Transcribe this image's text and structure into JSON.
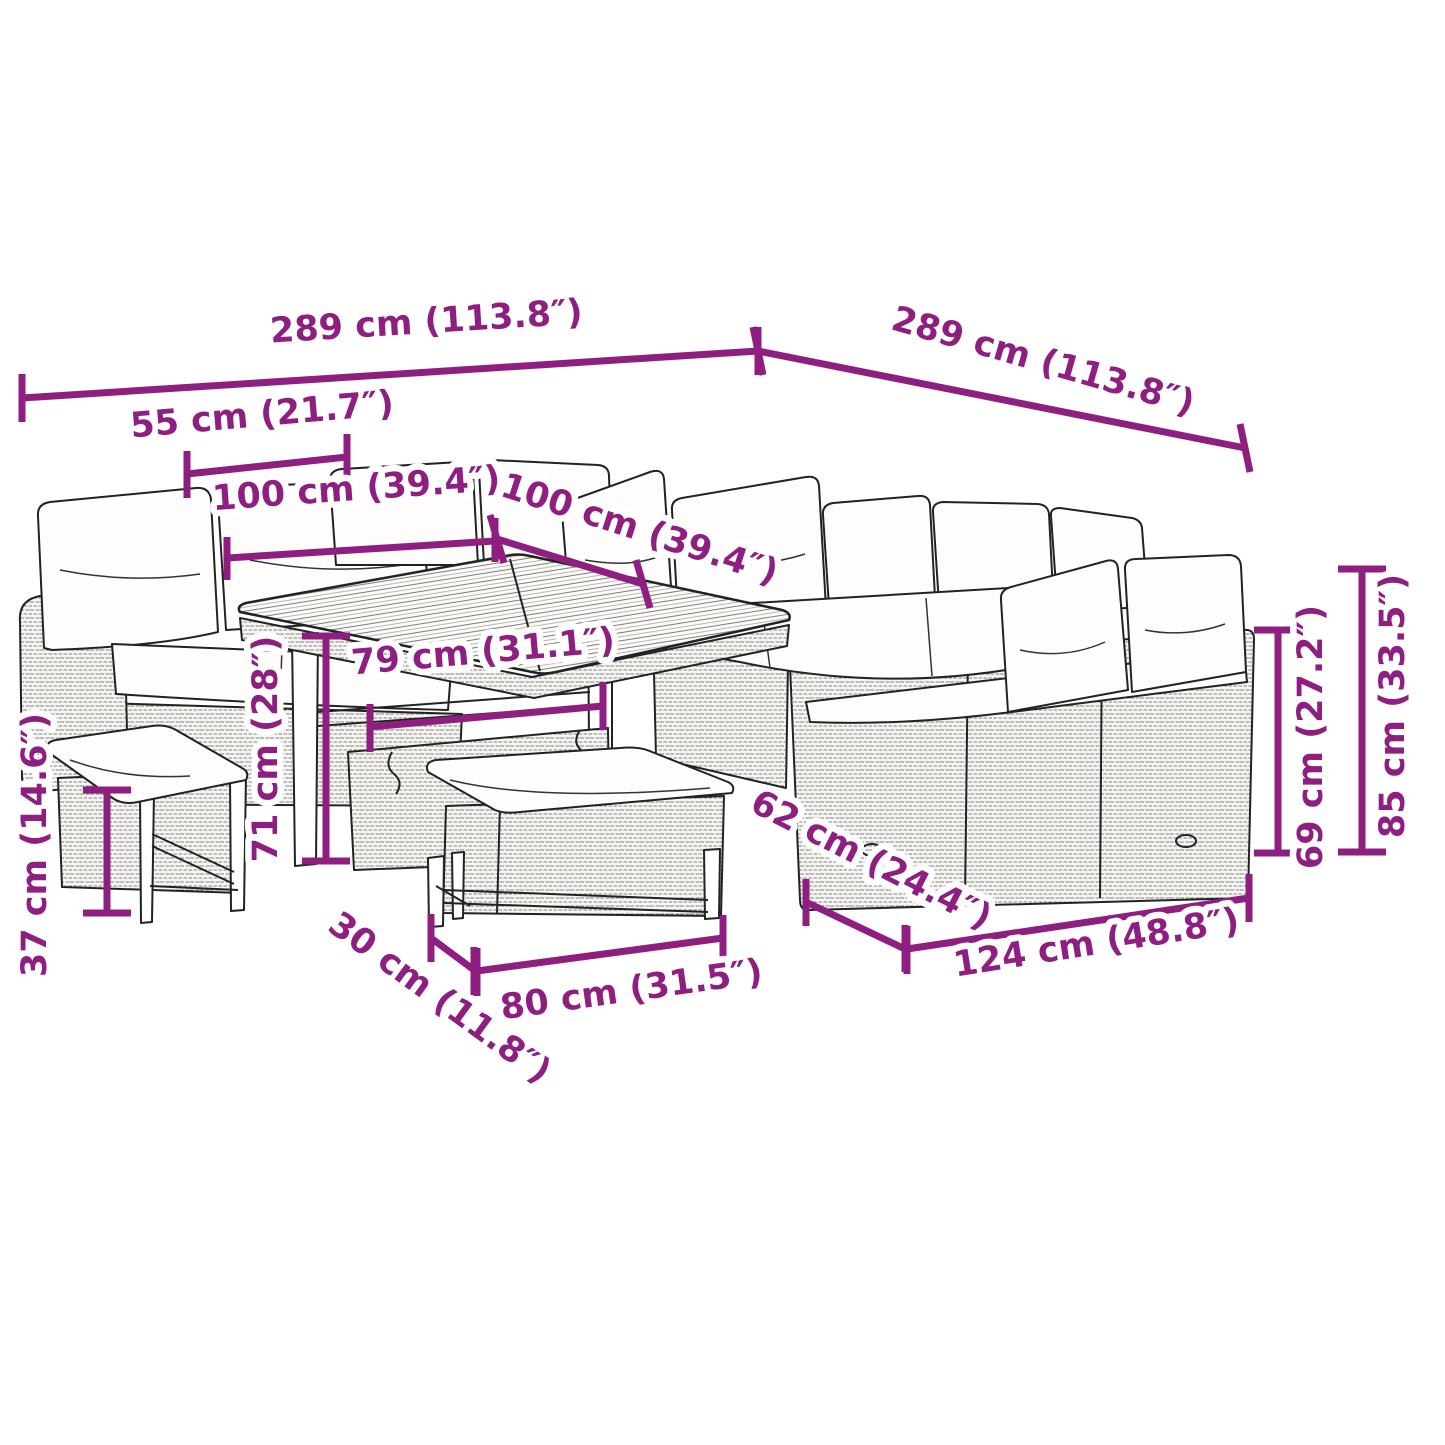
{
  "diagram": {
    "accent_color": "#8E1F80",
    "line_color": "#222222"
  },
  "dimensions": {
    "overall_width_left": {
      "cm": 289,
      "in": 113.8,
      "label": "289 cm (113.8″)"
    },
    "overall_width_right": {
      "cm": 289,
      "in": 113.8,
      "label": "289 cm (113.8″)"
    },
    "bench_small_width": {
      "cm": 55,
      "in": 21.7,
      "label": "55 cm (21.7″)"
    },
    "table_width": {
      "cm": 100,
      "in": 39.4,
      "label": "100 cm (39.4″)"
    },
    "table_depth": {
      "cm": 100,
      "in": 39.4,
      "label": "100 cm (39.4″)"
    },
    "table_frame_width": {
      "cm": 79,
      "in": 31.1,
      "label": "79 cm (31.1″)"
    },
    "table_height": {
      "cm": 71,
      "in": 28,
      "label": "71 cm (28″)"
    },
    "bench_small_height": {
      "cm": 37,
      "in": 14.6,
      "label": "37 cm (14.6″)"
    },
    "bench_long_depth": {
      "cm": 30,
      "in": 11.8,
      "label": "30 cm (11.8″)"
    },
    "bench_long_width": {
      "cm": 80,
      "in": 31.5,
      "label": "80 cm (31.5″)"
    },
    "sofa_depth": {
      "cm": 62,
      "in": 24.4,
      "label": "62 cm (24.4″)"
    },
    "sofa_width": {
      "cm": 124,
      "in": 48.8,
      "label": "124 cm (48.8″)"
    },
    "seat_back_height": {
      "cm": 69,
      "in": 27.2,
      "label": "69 cm (27.2″)"
    },
    "sofa_height": {
      "cm": 85,
      "in": 33.5,
      "label": "85 cm (33.5″)"
    }
  }
}
